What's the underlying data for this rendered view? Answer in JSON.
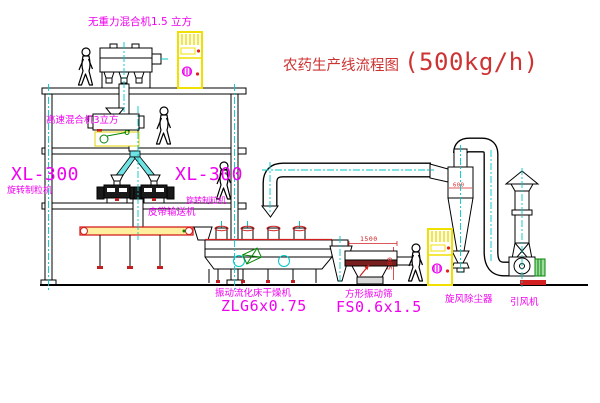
{
  "drawing": {
    "title": {
      "name_cn": "农药生产线流程图",
      "capacity": "(500kg/h)"
    },
    "equipment_labels": {
      "gravity_free_mixer": "无重力混合机1.5 立方",
      "high_speed_mixer": "高速混合机3立方",
      "granulator_left_model": "XL-300",
      "granulator_left_name": "旋转制粒机",
      "granulator_right_model": "XL-300",
      "granulator_right_name": "旋转制粒机",
      "belt_conveyor": "皮带输送机",
      "fluid_bed_dryer_name": "振动流化床干燥机",
      "fluid_bed_dryer_model": "ZLG6x0.75",
      "square_sieve_name": "方形振动筛",
      "square_sieve_model": "FS0.6x1.5",
      "cyclone_dust_collector": "旋风除尘器",
      "induced_draft_fan": "引风机"
    },
    "dimension_labels": {
      "sieve_length": "1500",
      "sieve_height": "500",
      "cyclone_width": "600"
    },
    "colors": {
      "label_magenta": "#f000f0",
      "title_red": "#cd3333",
      "centerline_cyan": "#00c8c8",
      "cabinet_yellow": "#f0e000",
      "dimension_red": "#d22020",
      "motor_green": "#068406"
    }
  }
}
